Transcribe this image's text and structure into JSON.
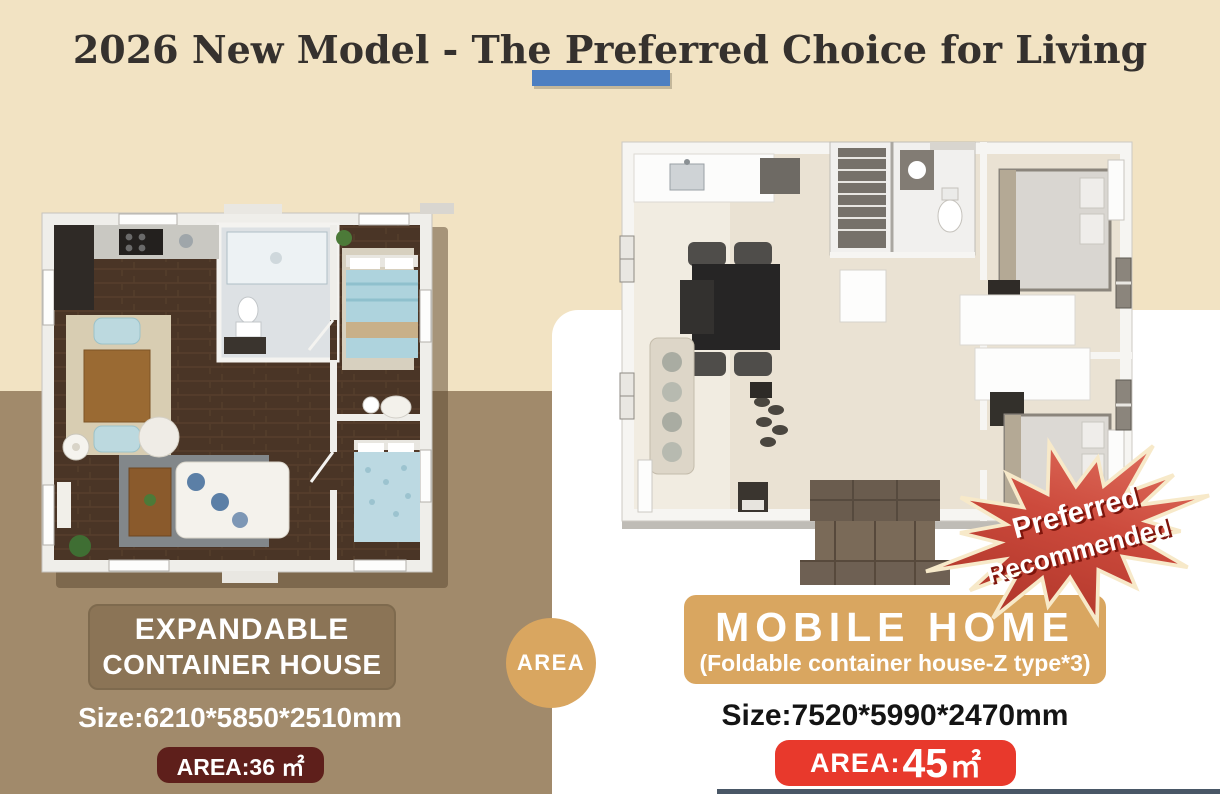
{
  "header": {
    "title": "2026 New Model - The Preferred Choice for Living"
  },
  "left_product": {
    "name_line1": "EXPANDABLE",
    "name_line2": "CONTAINER HOUSE",
    "size": "Size:6210*5850*2510mm",
    "area_badge": "AREA:36 ㎡"
  },
  "divider": {
    "circle_label": "AREA"
  },
  "right_product": {
    "name": "MOBILE HOME",
    "subtitle": "(Foldable container house-Z type*3)",
    "size": "Size:7520*5990*2470mm",
    "area_prefix": "AREA:",
    "area_value": "45",
    "area_unit": "㎡",
    "ribbon_line1": "Preferred",
    "ribbon_line2": "Recommended"
  },
  "colors": {
    "background_cream": "#f2e3c3",
    "band_brown": "#a18a6b",
    "card_white": "#ffffff",
    "accent_blue": "#4d7fc1",
    "gold_tan": "#d9a660",
    "maroon_badge": "#5e1f1b",
    "red_badge": "#e8392c",
    "ribbon_red": "#c23a2c",
    "title_ink": "#35312e"
  }
}
